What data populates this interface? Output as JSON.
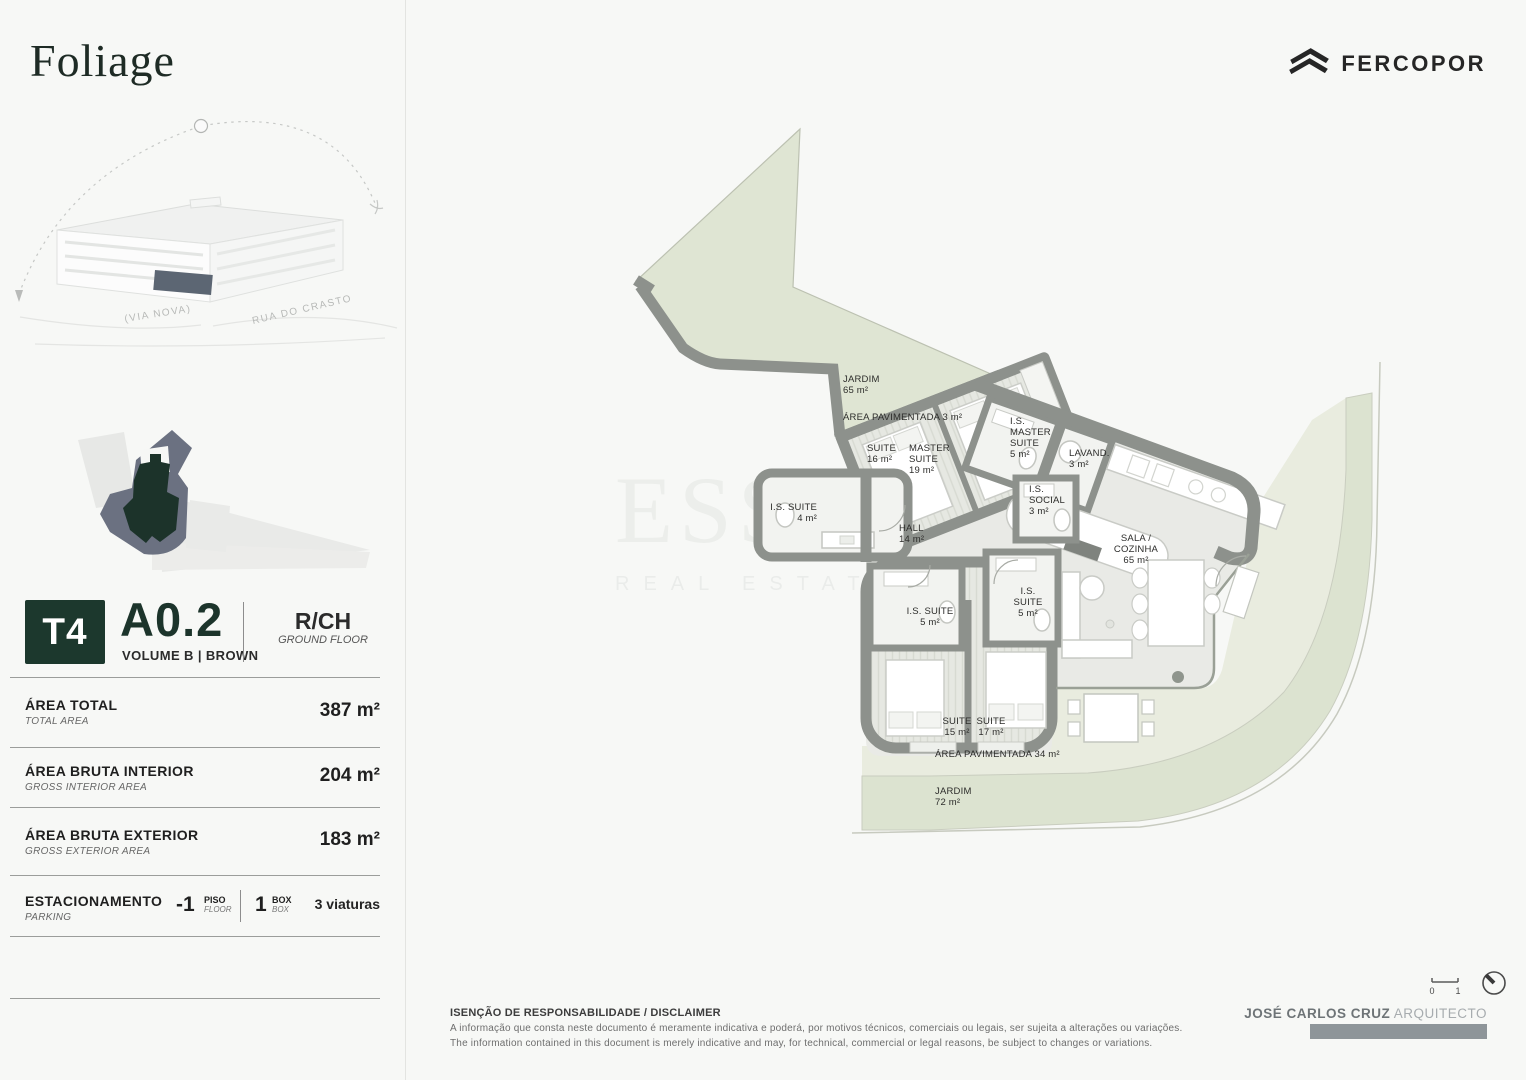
{
  "brand": {
    "logo": "Foliage",
    "developer": "FERCOPOR"
  },
  "key_plan": {
    "street_left": "(VIA NOVA)",
    "street_right": "RUA DO CRASTO"
  },
  "unit": {
    "typology": "T4",
    "id": "A0.2",
    "volume": "VOLUME B | BROWN",
    "floor_code": "R/CH",
    "floor_name": "GROUND FLOOR"
  },
  "areas": [
    {
      "label": "ÁREA TOTAL",
      "sub": "TOTAL AREA",
      "value": "387 m²"
    },
    {
      "label": "ÁREA BRUTA INTERIOR",
      "sub": "GROSS INTERIOR AREA",
      "value": "204 m²"
    },
    {
      "label": "ÁREA BRUTA EXTERIOR",
      "sub": "GROSS EXTERIOR AREA",
      "value": "183 m²"
    }
  ],
  "parking": {
    "label": "ESTACIONAMENTO",
    "sub": "PARKING",
    "floor_value": "-1",
    "floor_label": "PISO",
    "floor_sub": "FLOOR",
    "box_value": "1",
    "box_label": "BOX",
    "box_sub": "BOX",
    "cars": "3 viaturas"
  },
  "plan": {
    "rooms": [
      {
        "id": "jardim-65",
        "lines": [
          "JARDIM",
          "65 m²"
        ],
        "x": 843,
        "y": 374,
        "align": "left"
      },
      {
        "id": "area-pavimentada-3",
        "lines": [
          "ÁREA PAVIMENTADA   3 m²"
        ],
        "x": 843,
        "y": 412,
        "align": "left"
      },
      {
        "id": "suite-16",
        "lines": [
          "SUITE",
          "16 m²"
        ],
        "x": 867,
        "y": 443,
        "align": "left"
      },
      {
        "id": "master-suite",
        "lines": [
          "MASTER",
          "SUITE",
          "19 m²"
        ],
        "x": 909,
        "y": 443,
        "align": "left"
      },
      {
        "id": "is-master-suite",
        "lines": [
          "I.S.",
          "MASTER",
          "SUITE",
          "5 m²"
        ],
        "x": 1010,
        "y": 416,
        "align": "left"
      },
      {
        "id": "lavandaria",
        "lines": [
          "LAVAND.",
          "3 m²"
        ],
        "x": 1069,
        "y": 448,
        "align": "left"
      },
      {
        "id": "is-social",
        "lines": [
          "I.S.",
          "SOCIAL",
          "3 m²"
        ],
        "x": 1029,
        "y": 484,
        "align": "left"
      },
      {
        "id": "is-suite-4",
        "lines": [
          "I.S. SUITE",
          "4 m²"
        ],
        "x": 817,
        "y": 502,
        "align": "right"
      },
      {
        "id": "hall",
        "lines": [
          "HALL",
          "14 m²"
        ],
        "x": 899,
        "y": 523,
        "align": "left"
      },
      {
        "id": "sala-cozinha",
        "lines": [
          "SALA /",
          "COZINHA",
          "65 m²"
        ],
        "x": 1136,
        "y": 533,
        "align": "center"
      },
      {
        "id": "is-suite-5-left",
        "lines": [
          "I.S. SUITE",
          "5 m²"
        ],
        "x": 930,
        "y": 606,
        "align": "center"
      },
      {
        "id": "is-suite-5-right",
        "lines": [
          "I.S.",
          "SUITE",
          "5 m²"
        ],
        "x": 1028,
        "y": 586,
        "align": "center"
      },
      {
        "id": "suite-15",
        "lines": [
          "SUITE",
          "15 m²"
        ],
        "x": 957,
        "y": 716,
        "align": "center"
      },
      {
        "id": "suite-17",
        "lines": [
          "SUITE",
          "17 m²"
        ],
        "x": 991,
        "y": 716,
        "align": "center"
      },
      {
        "id": "area-pavimentada-34",
        "lines": [
          "ÁREA PAVIMENTADA   34 m²"
        ],
        "x": 935,
        "y": 749,
        "align": "left"
      },
      {
        "id": "jardim-72",
        "lines": [
          "JARDIM",
          "72 m²"
        ],
        "x": 935,
        "y": 786,
        "align": "left"
      }
    ],
    "watermark_big": "ESSIA",
    "watermark_small": "REAL ESTATE"
  },
  "scale": {
    "start": "0",
    "end": "1"
  },
  "disclaimer": {
    "title": "ISENÇÃO DE RESPONSABILIDADE / DISCLAIMER",
    "line_pt": "A informação que consta neste documento é meramente indicativa e poderá, por motivos técnicos, comerciais ou legais, ser sujeita a alterações ou variações.",
    "line_en": "The information contained in this document is merely indicative and may, for technical, commercial or legal reasons, be subject to changes or variations."
  },
  "credit": {
    "name": "JOSÉ CARLOS CRUZ",
    "title": "ARQUITECTO"
  },
  "colors": {
    "brand_green": "#1c382d",
    "wall_gray": "#8d918c",
    "garden_green": "#dfe5d3",
    "deck_green": "#e9ecdf"
  }
}
